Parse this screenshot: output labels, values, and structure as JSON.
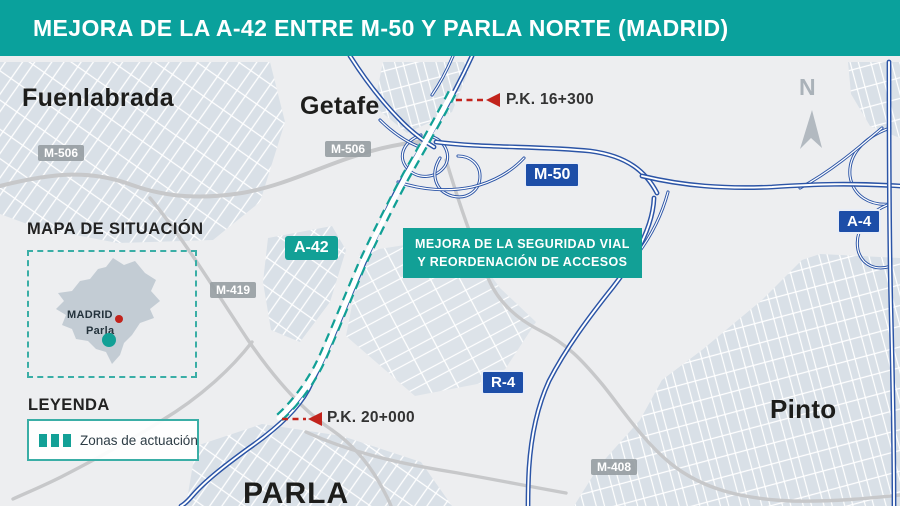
{
  "header": {
    "title": "MEJORA DE LA A-42 ENTRE M-50 Y PARLA NORTE (MADRID)"
  },
  "colors": {
    "header_teal": "#0aa19c",
    "accent_teal": "#12a096",
    "road_blue": "#2b54a6",
    "label_blue": "#1d4ea8",
    "marker_red": "#c2231c",
    "urban_fill": "#d9e0e7",
    "map_background": "#edeef0"
  },
  "cities": {
    "fuenlabrada": "Fuenlabrada",
    "getafe": "Getafe",
    "pinto": "Pinto",
    "parla": "PARLA"
  },
  "road_labels": {
    "m50": "M-50",
    "a4": "A-4",
    "r4": "R-4",
    "a42": "A-42",
    "m506_west": "M-506",
    "m506_getafe": "M-506",
    "m419": "M-419",
    "m408": "M-408"
  },
  "markers": {
    "pk_north": "P.K. 16+300",
    "pk_south": "P.K. 20+000"
  },
  "callout": {
    "line1": "MEJORA DE LA SEGURIDAD VIAL",
    "line2": "Y REORDENACIÓN DE ACCESOS"
  },
  "situation_map": {
    "title": "MAPA DE SITUACIÓN",
    "madrid": "MADRID",
    "parla": "Parla"
  },
  "legend": {
    "title": "LEYENDA",
    "item": "Zonas de actuación"
  },
  "compass": {
    "north": "N"
  }
}
